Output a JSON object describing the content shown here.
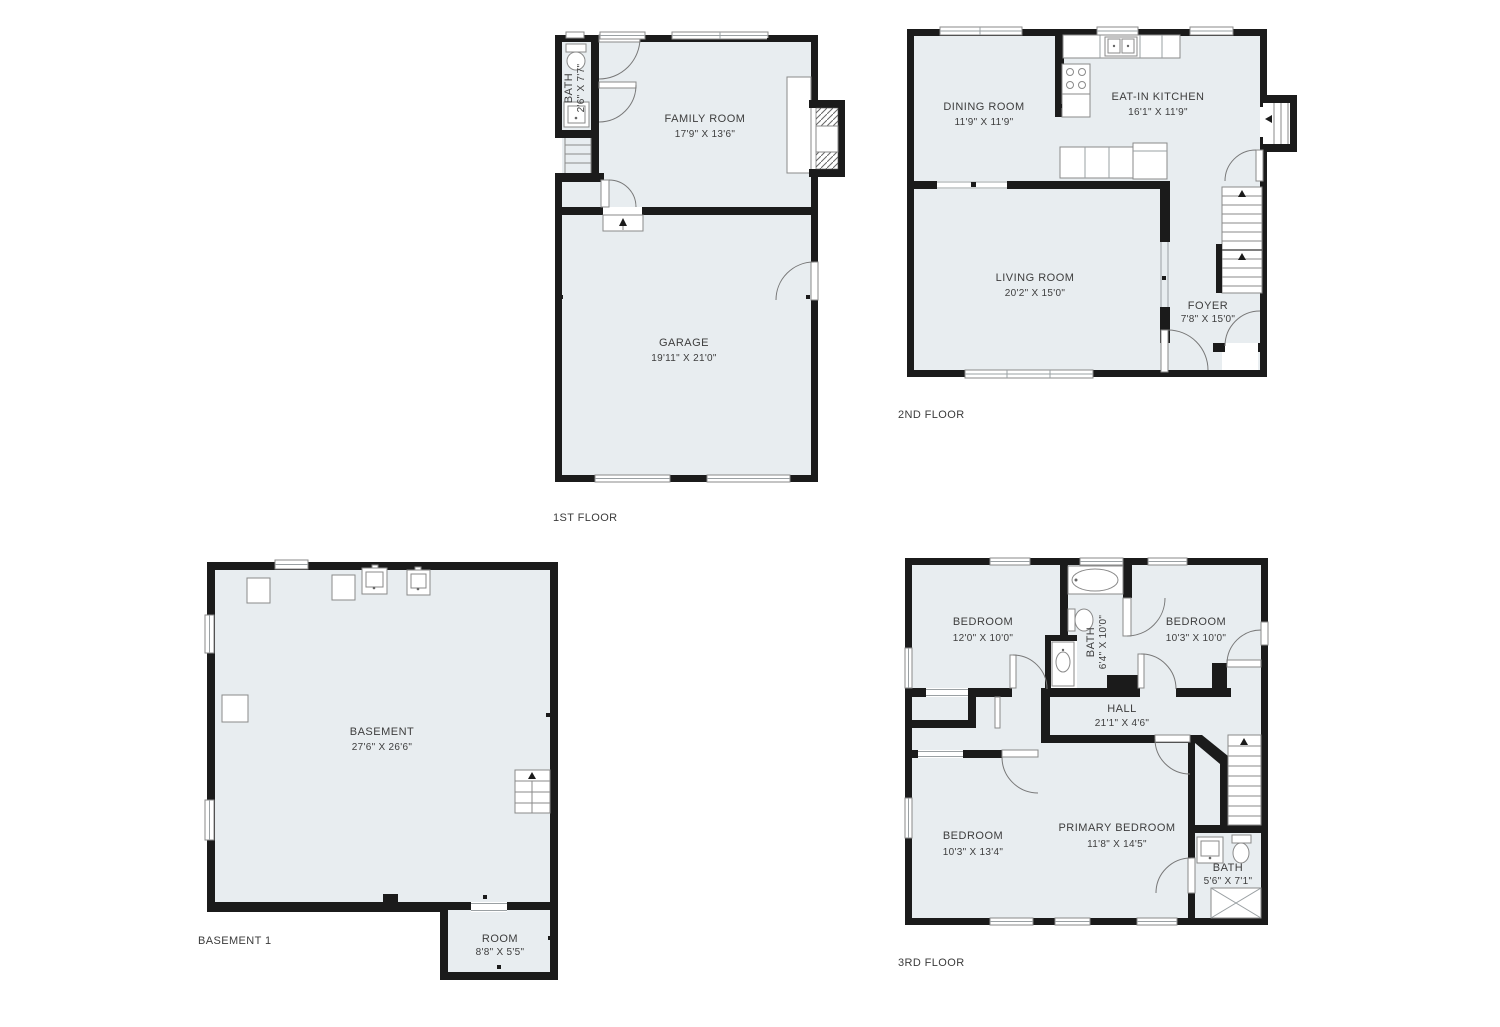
{
  "colors": {
    "wall": "#1b1b1b",
    "floor_fill": "#e8edf0",
    "background": "#ffffff"
  },
  "floors": {
    "first": {
      "title": "1ST FLOOR",
      "rooms": {
        "bath": {
          "name": "BATH",
          "dims": "2'6\" X 7'7\""
        },
        "family_room": {
          "name": "FAMILY ROOM",
          "dims": "17'9\" X 13'6\""
        },
        "garage": {
          "name": "GARAGE",
          "dims": "19'11\" X 21'0\""
        }
      }
    },
    "second": {
      "title": "2ND FLOOR",
      "rooms": {
        "dining_room": {
          "name": "DINING ROOM",
          "dims": "11'9\" X 11'9\""
        },
        "kitchen": {
          "name": "EAT-IN KITCHEN",
          "dims": "16'1\" X 11'9\""
        },
        "living_room": {
          "name": "LIVING ROOM",
          "dims": "20'2\" X 15'0\""
        },
        "foyer": {
          "name": "FOYER",
          "dims": "7'8\" X 15'0\""
        }
      }
    },
    "basement": {
      "title": "BASEMENT 1",
      "rooms": {
        "basement": {
          "name": "BASEMENT",
          "dims": "27'6\" X 26'6\""
        },
        "room": {
          "name": "ROOM",
          "dims": "8'8\" X 5'5\""
        }
      }
    },
    "third": {
      "title": "3RD FLOOR",
      "rooms": {
        "bedroom_top_left": {
          "name": "BEDROOM",
          "dims": "12'0\" X 10'0\""
        },
        "bath_upper": {
          "name": "BATH",
          "dims": "6'4\" X 10'0\""
        },
        "bedroom_top_right": {
          "name": "BEDROOM",
          "dims": "10'3\" X 10'0\""
        },
        "hall": {
          "name": "HALL",
          "dims": "21'1\" X 4'6\""
        },
        "bedroom_lower_left": {
          "name": "BEDROOM",
          "dims": "10'3\" X 13'4\""
        },
        "primary_bedroom": {
          "name": "PRIMARY BEDROOM",
          "dims": "11'8\" X 14'5\""
        },
        "bath_lower": {
          "name": "BATH",
          "dims": "5'6\" X 7'1\""
        }
      }
    }
  }
}
